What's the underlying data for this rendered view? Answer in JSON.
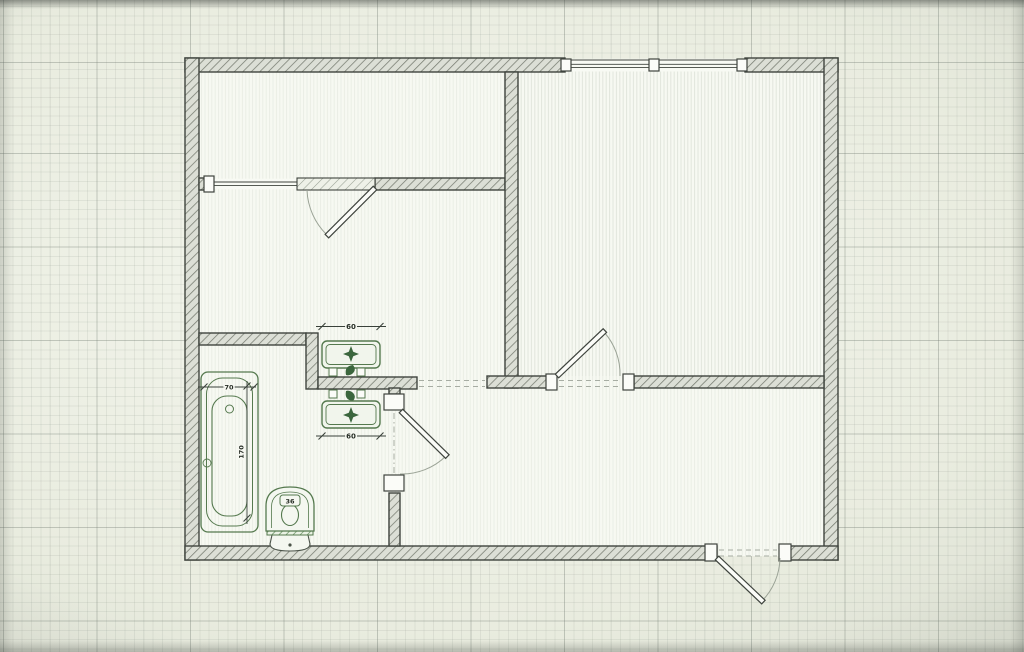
{
  "image": {
    "kind": "architectural floor plan displayed on a gridded screen",
    "colors": {
      "paper": "#e0e4d9",
      "grid_line": "#9aa296",
      "wall_outline": "#3f443e",
      "wall_hatch_fill": "#dcdfd6",
      "fixture_green": "#4e7a48",
      "floor": "#f7f9f2"
    }
  },
  "plan": {
    "dimension_labels": {
      "bathtub_width": "70",
      "bathtub_length": "170",
      "sink_top_width": "60",
      "sink_bottom_width": "60",
      "toilet_width": "36"
    },
    "fixtures": [
      "bathtub",
      "toilet",
      "washbasin-upper",
      "washbasin-lower"
    ],
    "openings": [
      "window-top-wall",
      "window-with-balcony-door",
      "living-room-door",
      "bathroom-door",
      "entrance-door"
    ]
  }
}
